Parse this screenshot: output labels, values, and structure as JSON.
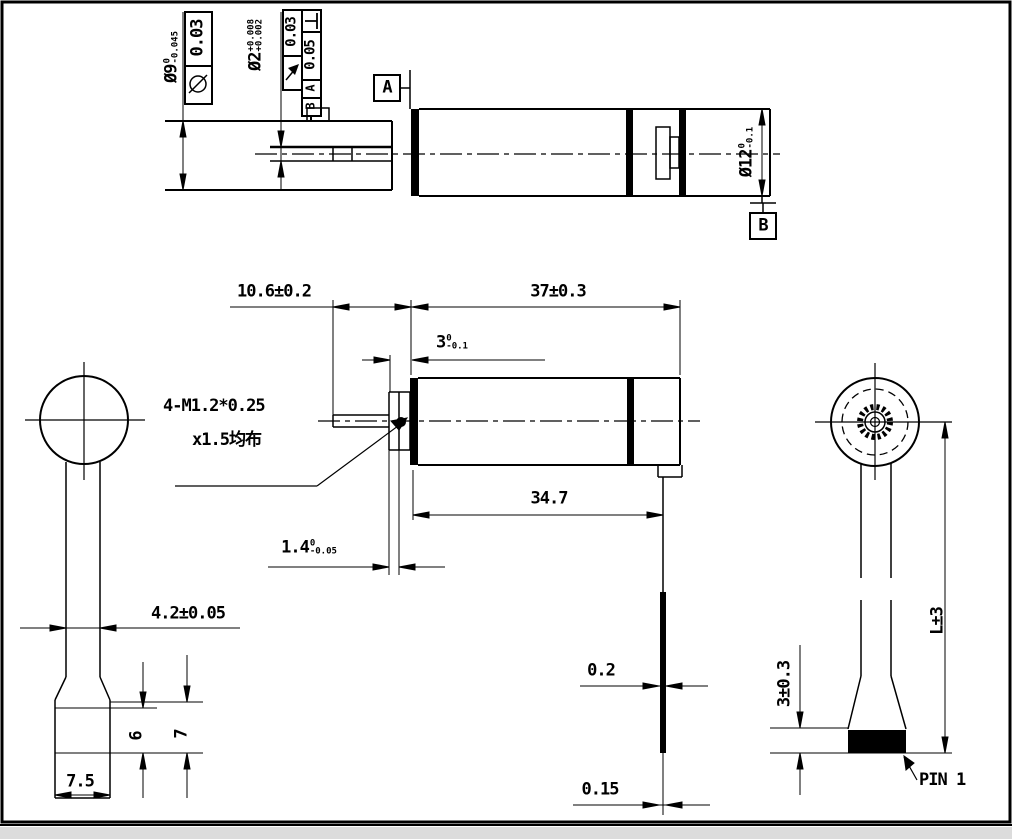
{
  "top_view": {
    "dia9_label": {
      "main": "Ø9",
      "upper": "0",
      "lower": "-0.045"
    },
    "dia2_label": {
      "main": "Ø2",
      "upper": "+0.008",
      "lower": "+0.002"
    },
    "dia12_label": {
      "main": "Ø12",
      "upper": "0",
      "lower": "-0.1"
    },
    "fcf_cylindricity": {
      "symbol": "cylindricity",
      "value": "0.03"
    },
    "fcf_runout": {
      "symbol": "circular-runout",
      "value": "0.03"
    },
    "fcf_perpendicularity": {
      "symbol": "perpendicularity",
      "value": "0.05",
      "datum_1": "A",
      "datum_2": "B"
    },
    "datum_a": "A",
    "datum_b": "B"
  },
  "side_view": {
    "dim_front_length": "10.6±0.2",
    "dim_motor_length": "37±0.3",
    "dim_pinion": {
      "main": "3",
      "upper": "0",
      "lower": "-0.1"
    },
    "screw_note_line1": "4-M1.2*0.25",
    "screw_note_line2": "x1.5均布",
    "dim_body": "34.7",
    "dim_plate": {
      "main": "1.4",
      "upper": "0",
      "lower": "-0.05"
    },
    "dim_washer_1": "0.2",
    "dim_washer_2": "0.15"
  },
  "front_view": {
    "dim_cable_width": "4.2±0.05",
    "dim_connector_1": "6",
    "dim_connector_2": "7",
    "dim_connector_width": "7.5"
  },
  "rear_view": {
    "dim_length": "L±3",
    "dim_pin_block": "3±0.3",
    "pin_label": "PIN 1"
  }
}
